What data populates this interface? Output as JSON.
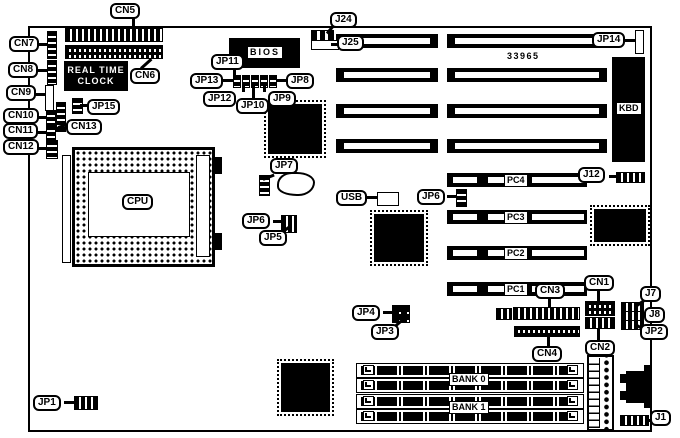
{
  "colors": {
    "ink": "#000000",
    "paper": "#ffffff"
  },
  "labels": {
    "cn1": "CN1",
    "cn2": "CN2",
    "cn3": "CN3",
    "cn4": "CN4",
    "cn5": "CN5",
    "cn6": "CN6",
    "cn7": "CN7",
    "cn8": "CN8",
    "cn9": "CN9",
    "cn10": "CN10",
    "cn11": "CN11",
    "cn12": "CN12",
    "cn13": "CN13",
    "j1": "J1",
    "j7": "J7",
    "j8": "J8",
    "j12": "J12",
    "j24": "J24",
    "j25": "J25",
    "jp1": "JP1",
    "jp2": "JP2",
    "jp3": "JP3",
    "jp4": "JP4",
    "jp5": "JP5",
    "jp6_left": "JP6",
    "jp6_right": "JP6",
    "jp7": "JP7",
    "jp8": "JP8",
    "jp9": "JP9",
    "jp10": "JP10",
    "jp11": "JP11",
    "jp12": "JP12",
    "jp13": "JP13",
    "jp14": "JP14",
    "jp15": "JP15"
  },
  "components": {
    "cpu": "CPU",
    "bios": "BIOS",
    "kbd": "KBD",
    "usb": "USB",
    "rtc_line1": "REAL TIME",
    "rtc_line2": "CLOCK",
    "part_number": "33965"
  },
  "slots": {
    "pc1": "PC1",
    "pc2": "PC2",
    "pc3": "PC3",
    "pc4": "PC4",
    "bank0": "BANK 0",
    "bank1": "BANK 1"
  }
}
